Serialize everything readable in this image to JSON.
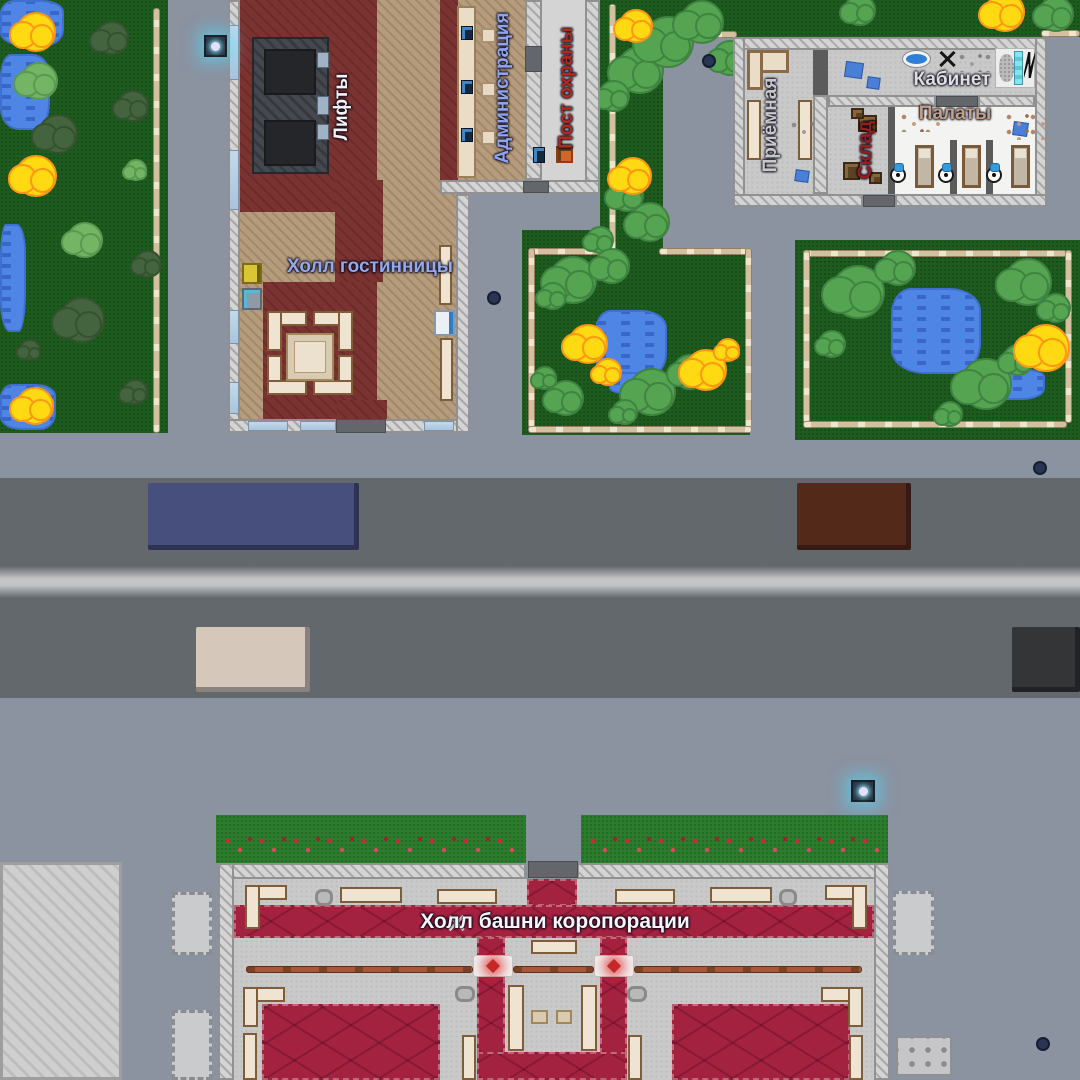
{
  "scene": {
    "description": "Top-down 2D game map: hotel lobby, hospital wing, parks, road with vehicles and corporate tower hall",
    "background_color": "#8b92a0",
    "road_color": "#63686d",
    "grass_color": "#1d5b1f",
    "hotel_carpet_color": "#7b3331",
    "corporate_carpet_color": "#a32240"
  },
  "labels": {
    "elevators": {
      "text": "Лифты",
      "color": "#f2f2f2"
    },
    "administration": {
      "text": "Администрация",
      "color": "#8fa3f0"
    },
    "security_post": {
      "text": "Пост охраны",
      "color": "#b3291f"
    },
    "hotel_hall": {
      "text": "Холл гостинницы",
      "color": "#97a8ea"
    },
    "office": {
      "text": "Кабинет",
      "color": "#dfdfdf"
    },
    "reception": {
      "text": "Приёмная",
      "color": "#c8c8c8"
    },
    "storage": {
      "text": "Склад",
      "color": "#9c1d1a"
    },
    "wards": {
      "text": "Палаты",
      "color": "#c2a083"
    },
    "corporate_hall": {
      "text": "Холл башни коропорации",
      "color": "#f5f5f5"
    }
  },
  "vehicles": {
    "bus": {
      "color": "#474f7d"
    },
    "car_brown": {
      "color": "#53291a"
    },
    "car_beige": {
      "color": "#d5c8bb"
    },
    "car_dark": {
      "color": "#333537"
    }
  },
  "icons": {
    "security_camera": "glowing cyan camera cube",
    "x_marker": "✕",
    "turnstile_gate": "white gate with red glowing diamond",
    "iv_stand": "white round stand with blue bag",
    "lightning": "black zigzag on medical scanner"
  }
}
